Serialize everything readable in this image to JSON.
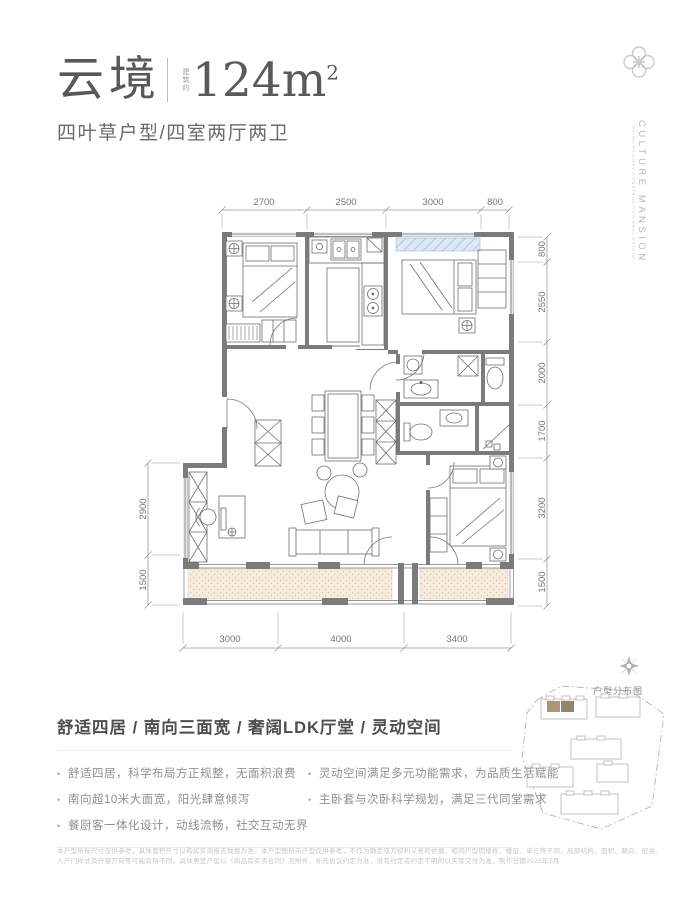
{
  "header": {
    "title": "云境",
    "area_prefix": "建筑约",
    "area_value": "124m",
    "area_sup": "2",
    "subtitle": "四叶草户型/四室两厅两卫"
  },
  "brand": {
    "name_vertical": "CULTURE MANSION",
    "tagline_vertical": "CHINA RAILWAY CONSTRUCTION REAL ESTATE"
  },
  "floorplan": {
    "dims_top": [
      "2700",
      "2500",
      "3000",
      "800"
    ],
    "dims_right": [
      "800",
      "2550",
      "2000",
      "1700",
      "3200",
      "1500"
    ],
    "dims_left": [
      "2900",
      "1500"
    ],
    "dims_bottom": [
      "3000",
      "4000",
      "3400"
    ]
  },
  "siteplan": {
    "label": "户型分布图"
  },
  "features": {
    "heading": "舒适四居 / 南向三面宽 / 奢阔LDK厅堂 / 灵动空间",
    "left": [
      "舒适四居，科学布局方正规整，无面积浪费",
      "南向超10米大面宽，阳光肆意倾泻",
      "餐厨客一体化设计，动线流畅，社交互动无界"
    ],
    "right": [
      "灵动空间满足多元功能需求，为品质生活赋能",
      "主卧套与次卧科学规划，满足三代同堂需求"
    ]
  },
  "disclaimer": "本户型所标尺寸仅供参考，具体面积尺寸以购房实测报告数据为准。本户型图所示户型仅供参考，不作为确定双方权利义务的依据。相同户型因楼栋、楼层、单元等不同，局部结构、面积、朝向、层高、入户门样式及开窗方向等可能有所不同。具体居室户型以《商品房买卖合同》及附件、补充协议约定为准，没有约定或约定不明的以实际交付为准。制作日期2025年7月",
  "colors": {
    "wall": "#7b7b7b",
    "bay_window_fill": "#dce9f4",
    "balcony_fill": "#f7ecdc",
    "highlight_unit_1": "#a89877",
    "highlight_unit_2": "#93846a"
  }
}
